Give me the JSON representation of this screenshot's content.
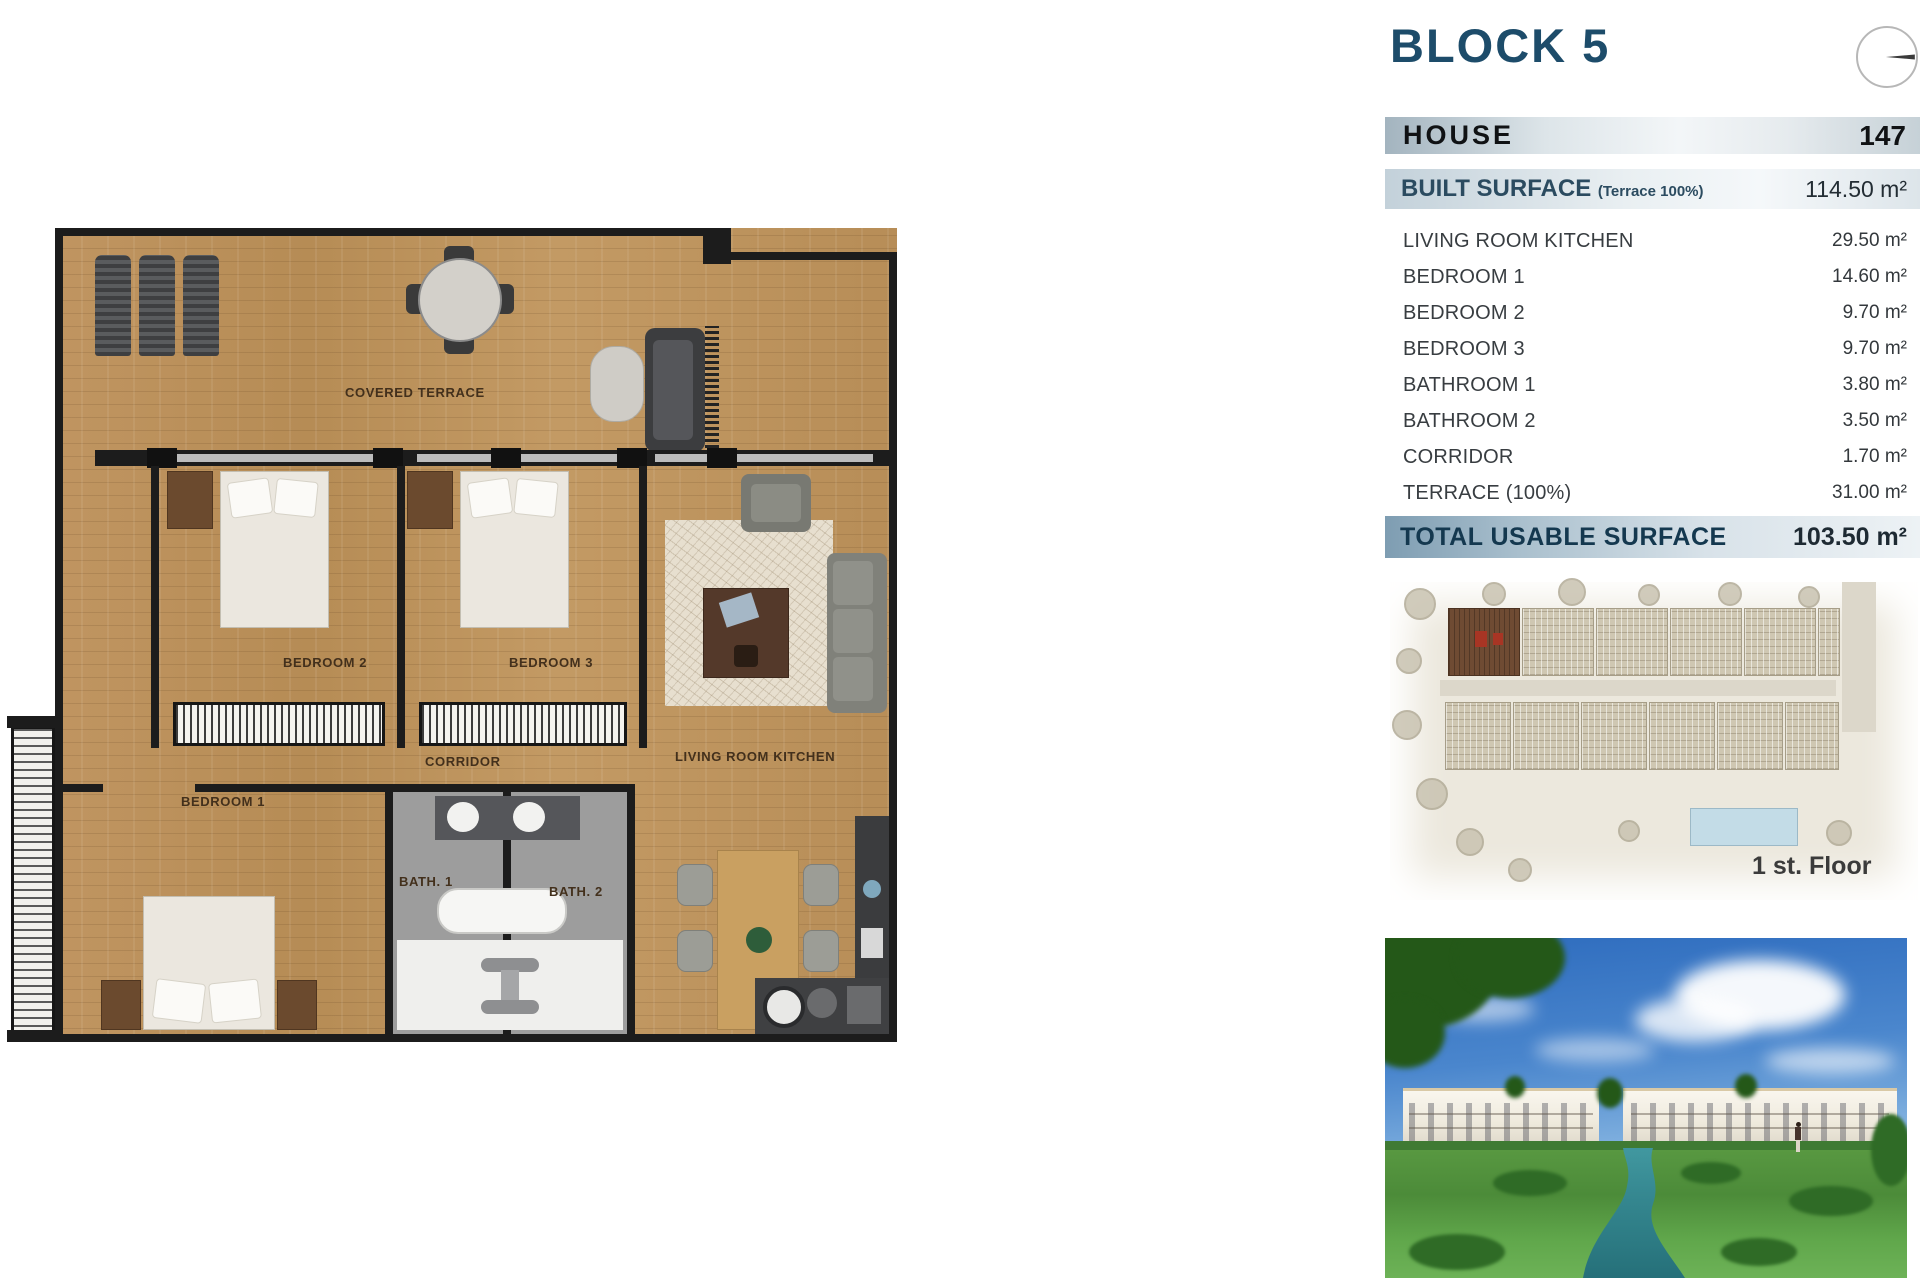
{
  "header": {
    "block_title": "BLOCK 5",
    "house_label": "HOUSE",
    "house_number": "147",
    "built_surface_label": "BUILT SURFACE",
    "built_surface_note": "(Terrace 100%)",
    "built_surface_value": "114.50 m²",
    "total_label": "TOTAL USABLE SURFACE",
    "total_value": "103.50 m²"
  },
  "rooms": [
    {
      "label": "LIVING ROOM KITCHEN",
      "value": "29.50 m²"
    },
    {
      "label": "BEDROOM 1",
      "value": "14.60 m²"
    },
    {
      "label": "BEDROOM 2",
      "value": "9.70 m²"
    },
    {
      "label": "BEDROOM 3",
      "value": "9.70 m²"
    },
    {
      "label": "BATHROOM 1",
      "value": "3.80 m²"
    },
    {
      "label": "BATHROOM 2",
      "value": "3.50 m²"
    },
    {
      "label": "CORRIDOR",
      "value": "1.70 m²"
    },
    {
      "label": "TERRACE (100%)",
      "value": "31.00 m²"
    }
  ],
  "floor_plan": {
    "labels": {
      "covered_terrace": "COVERED TERRACE",
      "bedroom1": "BEDROOM 1",
      "bedroom2": "BEDROOM 2",
      "bedroom3": "BEDROOM 3",
      "corridor": "CORRIDOR",
      "living_room_kitchen": "LIVING ROOM KITCHEN",
      "bath1": "BATH. 1",
      "bath2": "BATH. 2"
    }
  },
  "site_plan": {
    "caption": "1 st. Floor"
  },
  "colors": {
    "title_blue": "#1d4c6a",
    "total_bar_blue": "#7e9db2",
    "wood_floor": "#bd945c",
    "wall_black": "#1c1c1c",
    "highlight_unit_red": "#a83524",
    "site_bg": "#ece8dd",
    "river_teal": "#2e7d8c",
    "lawn_green": "#4c8b39",
    "sky_blue": "#2e6cbe"
  }
}
